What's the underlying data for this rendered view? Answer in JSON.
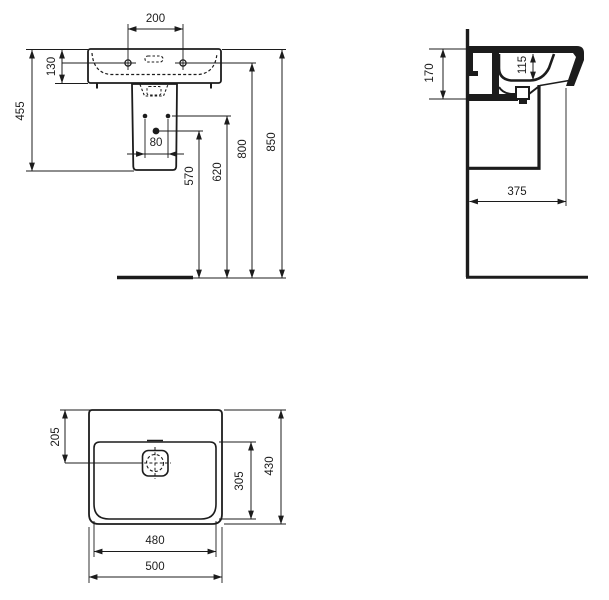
{
  "drawing": {
    "type": "washbasin-technical-drawing",
    "colors": {
      "ink": "#1c1c1c",
      "background": "#ffffff"
    },
    "front_view": {
      "dims": {
        "tap_hole_spacing": "200",
        "basin_height": "130",
        "height_to_pedestal_bottom": "455",
        "fixing_bolt_spacing": "80",
        "drain_outlet_height": "570",
        "fixing_hole_height": "620",
        "tap_hole_height": "800",
        "rim_height": "850"
      }
    },
    "side_view": {
      "dims": {
        "section_height_at_wall": "170",
        "bowl_inner_depth": "115",
        "overall_depth": "375"
      }
    },
    "plan_view": {
      "dims": {
        "drain_center_offset": "205",
        "bowl_inner_depth": "305",
        "overall_depth": "430",
        "inner_width": "480",
        "overall_width": "500"
      }
    }
  }
}
